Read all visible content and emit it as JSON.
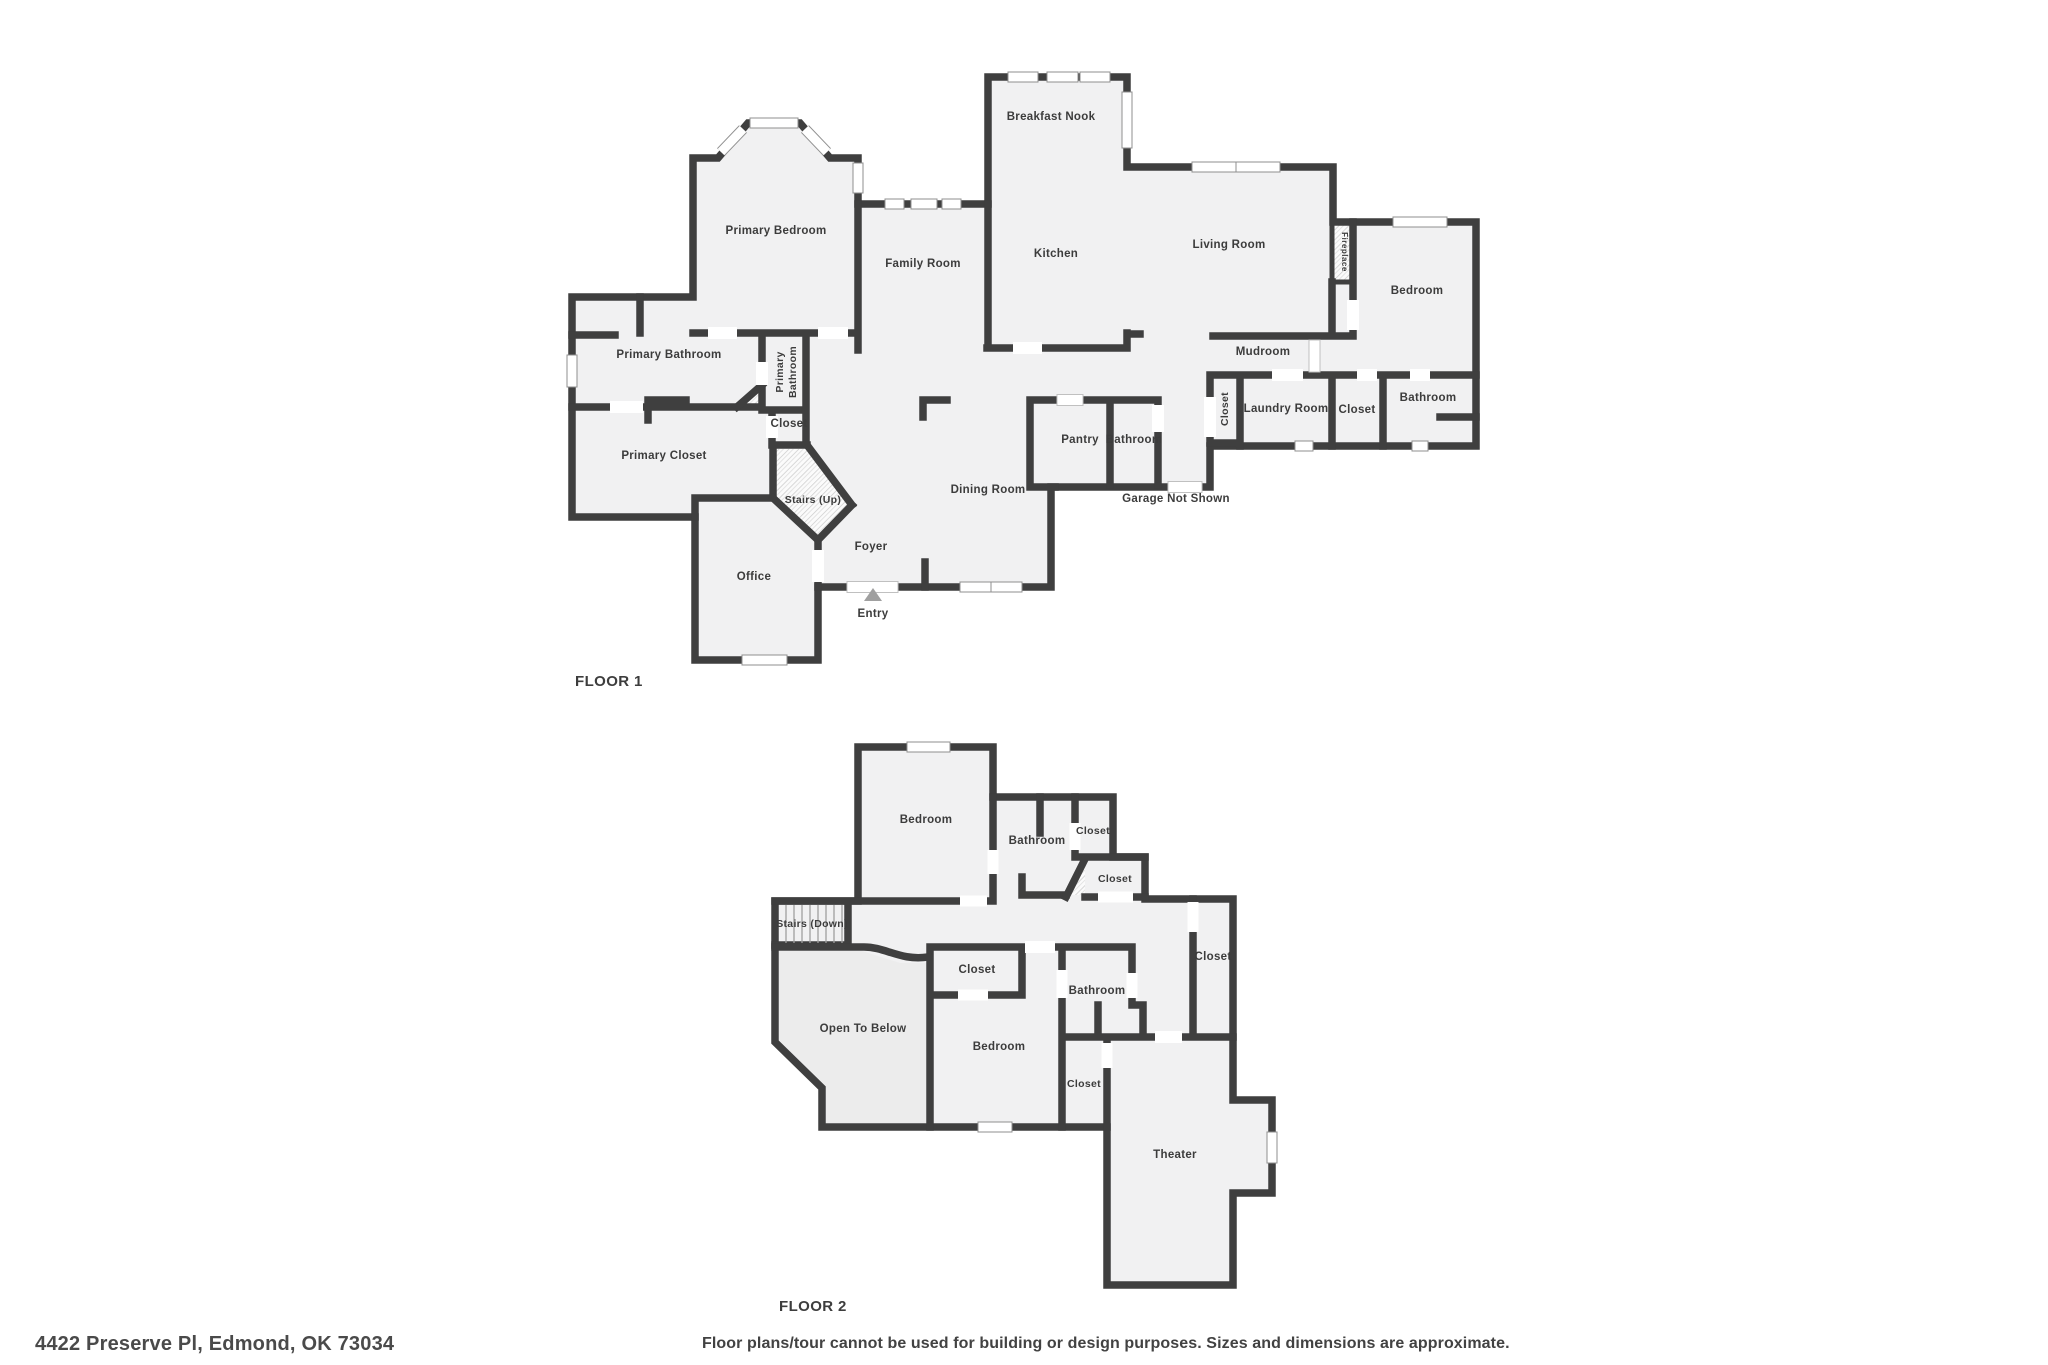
{
  "document": {
    "type": "real-estate floor plan",
    "background": "#ffffff"
  },
  "colors": {
    "wall": "#3f3f3f",
    "floor_fill": "#f1f1f2",
    "open_to_below_fill": "#ececec",
    "label_text": "#3c3c3c",
    "window_frame": "#8f8f8f",
    "entry_marker": "#a0a0a0"
  },
  "floor1": {
    "title": "FLOOR 1",
    "rooms": [
      {
        "label": "Breakfast Nook"
      },
      {
        "label": "Primary Bedroom"
      },
      {
        "label": "Kitchen"
      },
      {
        "label": "Living Room"
      },
      {
        "label": "Family Room"
      },
      {
        "label": "Fireplace"
      },
      {
        "label": "Bedroom"
      },
      {
        "label": "Primary Bathroom"
      },
      {
        "label": "Primary Bathroom",
        "line1": "Primary",
        "line2": "Bathroom"
      },
      {
        "label": "Mudroom"
      },
      {
        "label": "Closet"
      },
      {
        "label": "Laundry Room"
      },
      {
        "label": "Closet"
      },
      {
        "label": "Bathroom"
      },
      {
        "label": "Closet"
      },
      {
        "label": "Primary Closet"
      },
      {
        "label": "Pantry"
      },
      {
        "label": "Bathroom"
      },
      {
        "label": "Dining Room"
      },
      {
        "label": "Stairs (Up)"
      },
      {
        "label": "Garage Not Shown"
      },
      {
        "label": "Foyer"
      },
      {
        "label": "Office"
      },
      {
        "label": "Entry"
      }
    ]
  },
  "floor2": {
    "title": "FLOOR 2",
    "rooms": [
      {
        "label": "Bedroom"
      },
      {
        "label": "Bathroom"
      },
      {
        "label": "Closet"
      },
      {
        "label": "Closet"
      },
      {
        "label": "Stairs (Down)"
      },
      {
        "label": "Closet"
      },
      {
        "label": "Closet"
      },
      {
        "label": "Open To Below"
      },
      {
        "label": "Bedroom"
      },
      {
        "label": "Bathroom"
      },
      {
        "label": "Closet"
      },
      {
        "label": "Theater"
      }
    ]
  },
  "footer": {
    "address": "4422 Preserve Pl, Edmond, OK 73034",
    "disclaimer": "Floor plans/tour cannot be used for building or design purposes. Sizes and dimensions are approximate."
  }
}
